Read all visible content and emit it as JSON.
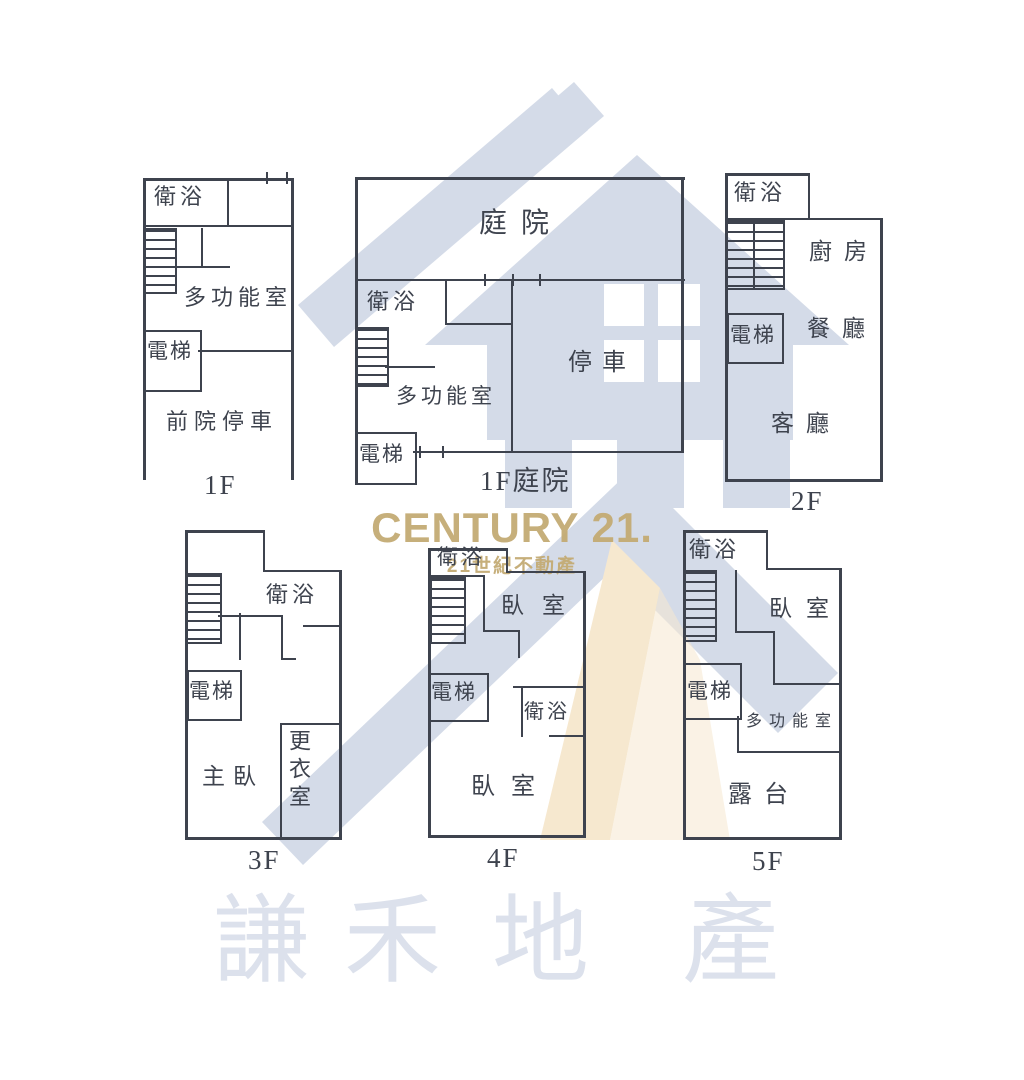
{
  "watermark": {
    "brand": "CENTURY 21.",
    "brand_sub": "21世紀不動產",
    "company_chars": [
      "謙",
      "禾",
      "地",
      "產"
    ]
  },
  "floors": {
    "f1_left": {
      "name": "1F",
      "bath": "衛浴",
      "multi": "多功能室",
      "elevator": "電梯",
      "parking": "前院停車"
    },
    "f1_mid": {
      "name": "1F庭院",
      "courtyard": "庭院",
      "bath": "衛浴",
      "multi": "多功能室",
      "elevator": "電梯",
      "parking": "停車"
    },
    "f2": {
      "name": "2F",
      "bath": "衛浴",
      "kitchen": "廚房",
      "elevator": "電梯",
      "dining": "餐廳",
      "living": "客廳"
    },
    "f3": {
      "name": "3F",
      "bath": "衛浴",
      "elevator": "電梯",
      "master": "主臥",
      "closet": "更衣室"
    },
    "f4": {
      "name": "4F",
      "bath_top": "衛浴",
      "bedroom_top": "臥室",
      "elevator": "電梯",
      "bath_mid": "衛浴",
      "bedroom_main": "臥室"
    },
    "f5": {
      "name": "5F",
      "bath": "衛浴",
      "bedroom": "臥室",
      "elevator": "電梯",
      "multi": "多功能室",
      "terrace": "露台"
    }
  },
  "colors": {
    "line": "#3e434e",
    "house_blue": "#d4dbe8",
    "cream": "#f6e8cf",
    "gold": "#c4ab74",
    "company": "#dce1ec"
  }
}
